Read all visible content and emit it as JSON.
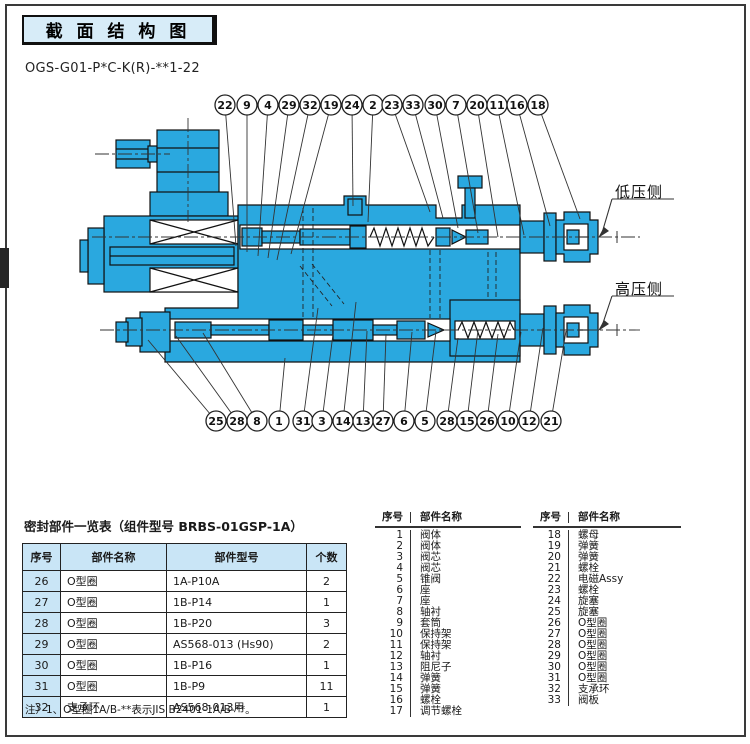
{
  "header": {
    "title": "截 面 结 构 图",
    "model_code": "OGS-G01-P*C-K(R)-**1-22"
  },
  "diagram": {
    "type": "hydraulic-valve-cross-section",
    "low_pressure_label": "低压侧",
    "high_pressure_label": "高压侧",
    "top_callouts": [
      "22",
      "9",
      "4",
      "29",
      "32",
      "19",
      "24",
      "2",
      "23",
      "33",
      "30",
      "7",
      "20",
      "11",
      "16",
      "18"
    ],
    "bottom_callouts": [
      "25",
      "28",
      "8",
      "1",
      "31",
      "3",
      "14",
      "13",
      "27",
      "6",
      "5",
      "28",
      "15",
      "26",
      "10",
      "12",
      "21"
    ],
    "body_color": "#2aa8df"
  },
  "seal_table": {
    "title": "密封部件一览表（组件型号 BRBS-01GSP-1A）",
    "headers": [
      "序号",
      "部件名称",
      "部件型号",
      "个数"
    ],
    "rows": [
      [
        "26",
        "O型圈",
        "1A-P10A",
        "2"
      ],
      [
        "27",
        "O型圈",
        "1B-P14",
        "1"
      ],
      [
        "28",
        "O型圈",
        "1B-P20",
        "3"
      ],
      [
        "29",
        "O型圈",
        "AS568-013 (Hs90)",
        "2"
      ],
      [
        "30",
        "O型圈",
        "1B-P16",
        "1"
      ],
      [
        "31",
        "O型圈",
        "1B-P9",
        "11"
      ],
      [
        "32",
        "支承环",
        "AS568-013用",
        "1"
      ]
    ],
    "note": "注）1、O型圈1A/B-**表示JIS B2401-1A/B-**。"
  },
  "parts_lists": [
    {
      "headers": [
        "序号",
        "部件名称"
      ],
      "rows": [
        [
          "1",
          "阀体"
        ],
        [
          "2",
          "阀体"
        ],
        [
          "3",
          "阀芯"
        ],
        [
          "4",
          "阀芯"
        ],
        [
          "5",
          "锥阀"
        ],
        [
          "6",
          "座"
        ],
        [
          "7",
          "座"
        ],
        [
          "8",
          "轴衬"
        ],
        [
          "9",
          "套筒"
        ],
        [
          "10",
          "保持架"
        ],
        [
          "11",
          "保持架"
        ],
        [
          "12",
          "轴衬"
        ],
        [
          "13",
          "阻尼子"
        ],
        [
          "14",
          "弹簧"
        ],
        [
          "15",
          "弹簧"
        ],
        [
          "16",
          "螺栓"
        ],
        [
          "17",
          "调节螺栓"
        ]
      ]
    },
    {
      "headers": [
        "序号",
        "部件名称"
      ],
      "rows": [
        [
          "18",
          "螺母"
        ],
        [
          "19",
          "弹簧"
        ],
        [
          "20",
          "弹簧"
        ],
        [
          "21",
          "螺栓"
        ],
        [
          "22",
          "电磁Assy"
        ],
        [
          "23",
          "螺栓"
        ],
        [
          "24",
          "旋塞"
        ],
        [
          "25",
          "旋塞"
        ],
        [
          "26",
          "O型圈"
        ],
        [
          "27",
          "O型圈"
        ],
        [
          "28",
          "O型圈"
        ],
        [
          "29",
          "O型圈"
        ],
        [
          "30",
          "O型圈"
        ],
        [
          "31",
          "O型圈"
        ],
        [
          "32",
          "支承环"
        ],
        [
          "33",
          "阀板"
        ]
      ]
    }
  ]
}
